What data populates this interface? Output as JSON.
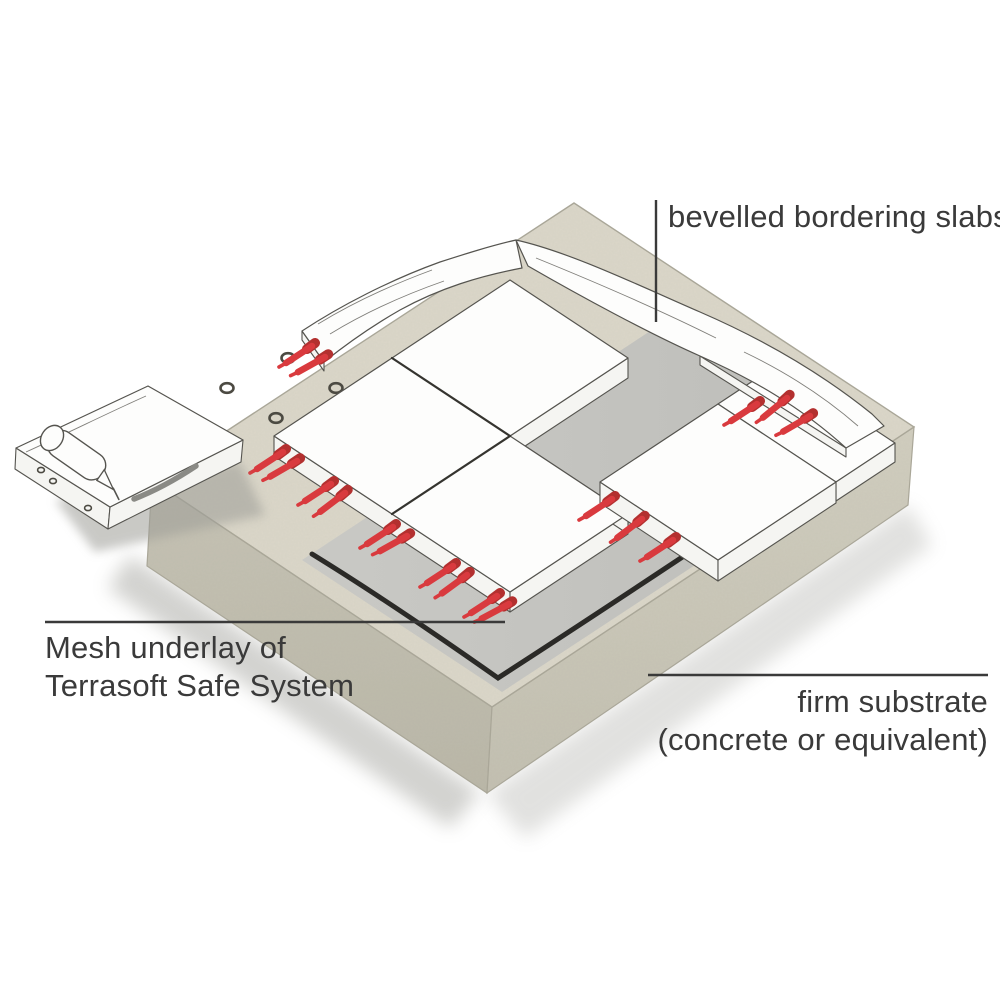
{
  "labels": {
    "bordering_slabs": "bevelled bordering slabs",
    "mesh_line1": "Mesh underlay of",
    "mesh_line2": "Terrasoft Safe System",
    "substrate_line1": "firm substrate",
    "substrate_line2": "(concrete or equivalent)"
  },
  "colors": {
    "background": "#ffffff",
    "substrate-top": "#dbd7c9",
    "substrate-left": "#c6c3b4",
    "substrate-left-dark": "#bab7a8",
    "substrate-right": "#d1cebf",
    "substrate-right-dark": "#c3c0b1",
    "substrate-edge": "#aaa799",
    "mesh-gray": "#c9c9c5",
    "mesh-gray-dark": "#bdbdb9",
    "mesh-line": "#2b2a27",
    "slab-fill": "#fdfdfc",
    "slab-side": "#f5f5f2",
    "slab-outline": "#55544f",
    "joint-dark": "#35342f",
    "pin-red": "#d93a3e",
    "pin-dark": "#b3302f",
    "ring-stroke": "#4c4a42",
    "bead-gray": "#8a8a85",
    "shadow": "#9d9d97",
    "text": "#3a3a3a",
    "leader": "#3a3a3a"
  }
}
